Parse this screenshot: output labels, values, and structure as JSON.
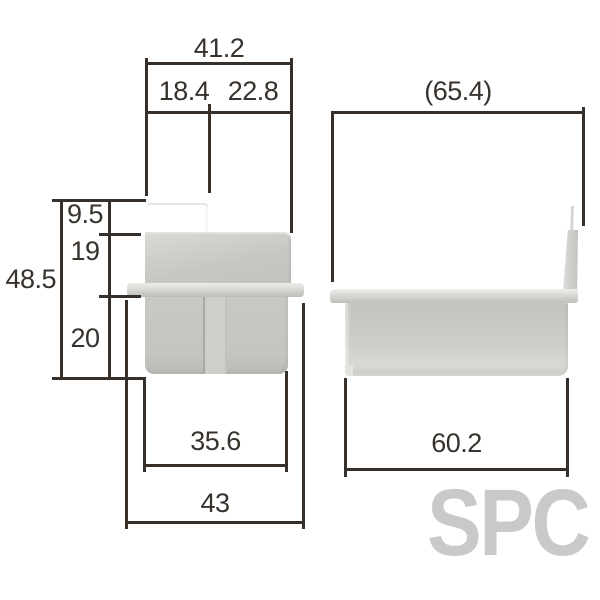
{
  "watermark": {
    "text": "SPC"
  },
  "colors": {
    "background": "#ffffff",
    "line": "#37302a",
    "label_text": "#38322d",
    "part_fill": "#c9c9c5",
    "part_highlight": "#e8e8e4",
    "part_shadow": "#b2b2ae",
    "watermark": "#c9c9c9"
  },
  "views": {
    "front": {
      "name": "front view",
      "dimensions": {
        "overall_width": "41.2",
        "upper_left_width": "18.4",
        "upper_right_width": "22.8",
        "overall_height": "48.5",
        "top_step_height": "9.5",
        "mid_height": "19",
        "lower_height": "20",
        "body_width": "35.6",
        "flange_width": "43"
      }
    },
    "side": {
      "name": "side view",
      "dimensions": {
        "overall_depth_ref": "(65.4)",
        "body_depth": "60.2"
      }
    }
  }
}
